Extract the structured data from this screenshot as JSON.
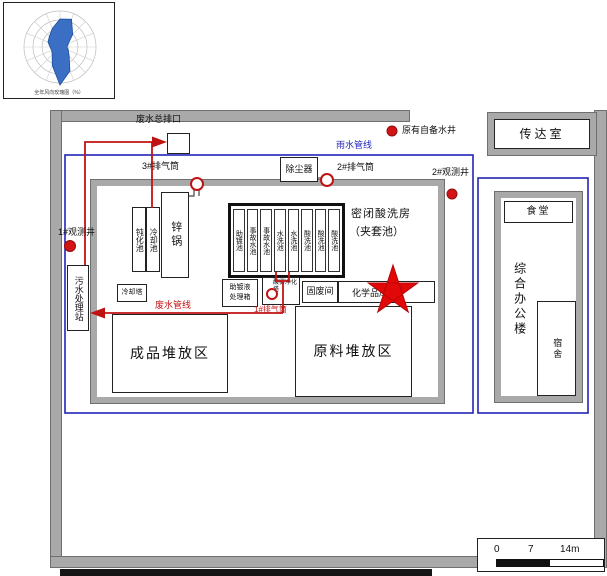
{
  "colors": {
    "pipe_red": "#c11212",
    "pipe_blue": "#2323b8",
    "wall_gray": "#a9a9a9",
    "well_red": "#d41414",
    "star_red": "#e00808"
  },
  "wind_rose": {
    "caption": "全年风向玫瑰图（%）"
  },
  "top": {
    "main_outfall": "废水总排口",
    "stack3": "3#排气筒",
    "dust_collector": "除尘器",
    "stack2": "2#排气筒",
    "rain_pipe": "雨水管线",
    "existing_well": "原有自备水井",
    "gatehouse": "传达室",
    "obs_well2": "2#观测井"
  },
  "workshop": {
    "passivation": "钝化池",
    "cooling_pool": "冷却池",
    "zinc_pot": "锌锅",
    "pools": [
      "助镀池",
      "事故水池",
      "事故水池",
      "水洗池",
      "水洗池",
      "酸洗池",
      "酸洗池",
      "酸洗池"
    ],
    "pickling_room_line1": "密闭酸洗房",
    "pickling_room_line2": "（夹套池）",
    "cooling_tower": "冷却塔",
    "flux_box_line1": "助镀液",
    "flux_box_line2": "处理箱",
    "scrubber": "酸雾净化塔",
    "stack1": "1#排气筒",
    "solid_waste": "固废间",
    "chem_store": "化学品库",
    "finished_area": "成品堆放区",
    "raw_area": "原料堆放区"
  },
  "left_side": {
    "sewage_station": "污水处理站",
    "obs_well1": "1#观测井",
    "waste_pipe": "废水管线"
  },
  "right_side": {
    "canteen": "食堂",
    "office": "综合办公楼",
    "dorm": "宿舍"
  },
  "scale_bar": {
    "tick0": "0",
    "tick1": "7",
    "tick2": "14m"
  }
}
